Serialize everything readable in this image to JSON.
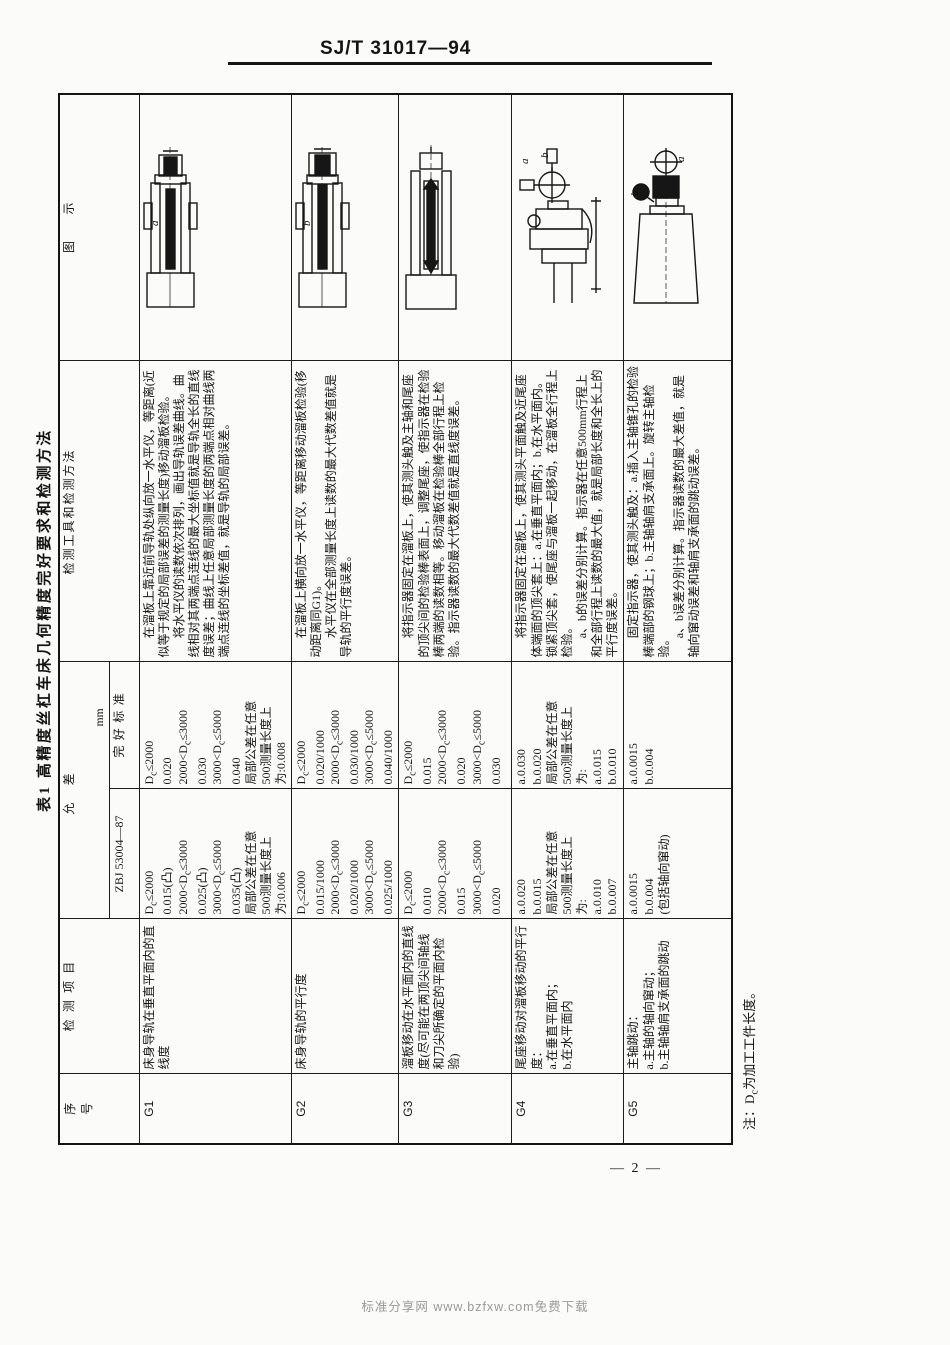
{
  "page": {
    "standard_no": "SJ/T 31017—94",
    "page_number": "— 2 —",
    "watermark": "标准分享网 www.bzfxw.com免费下载"
  },
  "table": {
    "title": "表1 高精度丝杠车床几何精度完好要求和检测方法",
    "unit": "mm",
    "note": "注：Dc为加工工件长度。",
    "headers": {
      "serial": "序号",
      "item": "检测项目",
      "tolerance": "允 差",
      "zbj": "ZBJ 53004—87",
      "good": "完好标准",
      "method": "检测工具和检测方法",
      "figure": "图示"
    },
    "rows": [
      {
        "id": "G1",
        "item_lines": [
          "床身导轨在垂直平面内的直线度"
        ],
        "zbj_lines": [
          "Dc≤2000",
          "0.015(凸)",
          "2000<Dc≤3000",
          "0.025(凸)",
          "3000<Dc≤5000",
          "0.035(凸)",
          "局部公差在任意",
          "500测量长度上",
          "为:0.006"
        ],
        "good_lines": [
          "Dc≤2000",
          "0.020",
          "2000<Dc≤3000",
          "0.030",
          "3000<Dc≤5000",
          "0.040",
          "局部公差在任意",
          "500测量长度上",
          "为:0.008"
        ],
        "method_paras": [
          "在溜板上靠近前导轨处纵向放一水平仪，等距离(近似等于规定的局部误差的测量长度)移动溜板检验。",
          "将水平仪的读数依次排列，画出导轨误差曲线。曲线相对其两端点连线的最大坐标值就是导轨全长的直线度误差；曲线上任意局部测量长度的两端点相对曲线两端点连线的坐标差值，就是导轨的局部误差。"
        ],
        "figure_labels": [
          "a"
        ]
      },
      {
        "id": "G2",
        "item_lines": [
          "床身导轨的平行度"
        ],
        "zbj_lines": [
          "Dc≤2000",
          "0.015/1000",
          "2000<Dc≤3000",
          "0.020/1000",
          "3000<Dc≤5000",
          "0.025/1000"
        ],
        "good_lines": [
          "Dc≤2000",
          "0.020/1000",
          "2000<Dc≤3000",
          "0.030/1000",
          "3000<Dc≤5000",
          "0.040/1000"
        ],
        "method_paras": [
          "在溜板上横向放一水平仪，等距离移动溜板检验(移动距离同G1)。",
          "水平仪在全部测量长度上读数的最大代数差值就是导轨的平行度误差。"
        ],
        "figure_labels": [
          "b"
        ]
      },
      {
        "id": "G3",
        "item_lines": [
          "溜板移动在水平面内的直线度(尽可能在两顶尖间轴线和刀尖所确定的平面内检验)"
        ],
        "zbj_lines": [
          "Dc≤2000",
          "0.010",
          "2000<Dc≤3000",
          "0.015",
          "3000<Dc≤5000",
          "0.020"
        ],
        "good_lines": [
          "Dc≤2000",
          "0.015",
          "2000<Dc≤3000",
          "0.020",
          "3000<Dc≤5000",
          "0.030"
        ],
        "method_paras": [
          "将指示器固定在溜板上，使其测头触及主轴和尾座的顶尖间的检验棒表面上，调整尾座，使指示器在检验棒两端的读数相等。移动溜板在检验棒全部行程上检验。指示器读数的最大代数差值就是直线度误差。"
        ],
        "figure_labels": []
      },
      {
        "id": "G4",
        "item_lines": [
          "尾座移动对溜板移动的平行度：",
          "a.在垂直平面内；",
          "b.在水平面内"
        ],
        "zbj_lines": [
          "a.0.020",
          "b.0.015",
          "局部公差在任意",
          "500测量长度上",
          "为:",
          "a.0.010",
          "b.0.007"
        ],
        "good_lines": [
          "a.0.030",
          "b.0.020",
          "局部公差在任意",
          "500测量长度上",
          "为:",
          "a.0.015",
          "b.0.010"
        ],
        "method_paras": [
          "将指示器固定在溜板上，使其测头平面触及近尾座体端面的顶尖套上：a.在垂直平面内；b.在水平面内。锁紧顶尖套，使尾座与溜板一起移动，在溜板全行程上检验。",
          "a、b的误差分别计算。指示器在任意500mm行程上和全部行程上读数的最大值，就是局部长度和全长上的平行度误差。"
        ],
        "figure_labels": [
          "a",
          "b"
        ]
      },
      {
        "id": "G5",
        "item_lines": [
          "主轴跳动：",
          "a.主轴的轴向窜动；",
          "b.主轴轴肩支承面的跳动"
        ],
        "zbj_lines": [
          "a.0.0015",
          "b.0.004",
          "(包括轴向窜动)"
        ],
        "good_lines": [
          "a.0.0015",
          "b.0.004"
        ],
        "method_paras": [
          "固定指示器，使其测头触及：a.插入主轴锥孔的检验棒端部的钢球上；b.主轴轴肩支承面上。旋转主轴检验。",
          "a、b误差分别计算。指示器读数的最大差值，就是轴向窜动误差和轴肩支承面的跳动误差。"
        ],
        "figure_labels": [
          "a",
          "b"
        ]
      }
    ]
  }
}
